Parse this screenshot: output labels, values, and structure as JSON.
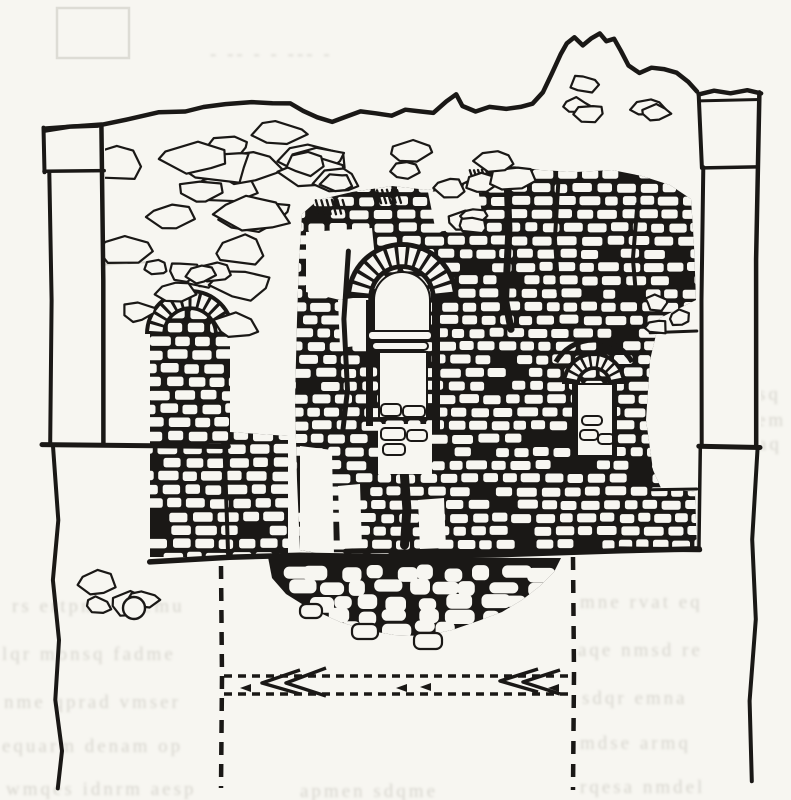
{
  "figure": {
    "description": "Scanned pen-and-ink archaeological elevation drawing of a ruined brick wall with three arched niches, flanked by two plain pilasters, rubble foundation mound below, and dashed reconstruction/section lines with left-pointing arrows at the bottom",
    "visible_text": "",
    "bleed_note": "illegible mirrored text bleeding through the page"
  },
  "palette": {
    "paper": "#f7f6f1",
    "ink": "#1a1816",
    "bleed": "#b6b4aa",
    "faint": "#c9c7bd"
  },
  "canvas": {
    "width": 791,
    "height": 800
  },
  "drawing": {
    "top_edge": [
      [
        44,
        131
      ],
      [
        70,
        127
      ],
      [
        98,
        125
      ],
      [
        128,
        119
      ],
      [
        158,
        113
      ],
      [
        186,
        112
      ],
      [
        204,
        107
      ],
      [
        226,
        104
      ],
      [
        252,
        102
      ],
      [
        272,
        103
      ],
      [
        290,
        104
      ],
      [
        303,
        111
      ],
      [
        318,
        118
      ],
      [
        332,
        122
      ],
      [
        344,
        118
      ],
      [
        360,
        112
      ],
      [
        376,
        114
      ],
      [
        392,
        116
      ],
      [
        406,
        110
      ],
      [
        420,
        112
      ],
      [
        434,
        113
      ],
      [
        447,
        101
      ],
      [
        456,
        95
      ],
      [
        463,
        106
      ],
      [
        476,
        111
      ],
      [
        490,
        107
      ],
      [
        506,
        109
      ],
      [
        520,
        107
      ],
      [
        533,
        104
      ],
      [
        543,
        92
      ],
      [
        552,
        73
      ],
      [
        560,
        55
      ],
      [
        567,
        43
      ],
      [
        575,
        38
      ],
      [
        583,
        45
      ],
      [
        591,
        38
      ],
      [
        600,
        34
      ],
      [
        607,
        41
      ],
      [
        614,
        39
      ],
      [
        621,
        51
      ],
      [
        629,
        65
      ],
      [
        640,
        73
      ],
      [
        652,
        67
      ],
      [
        664,
        69
      ],
      [
        676,
        73
      ],
      [
        688,
        82
      ],
      [
        697,
        92
      ]
    ],
    "left_pillar": {
      "fill": [
        44,
        124,
        61,
        320
      ],
      "cap_top": [
        [
          44,
          128
        ],
        [
          102,
          124
        ]
      ],
      "cap_bottom": [
        [
          44,
          172
        ],
        [
          104,
          171
        ]
      ],
      "cap_left": [
        [
          44,
          128
        ],
        [
          44,
          172
        ]
      ],
      "shaft_left": [
        [
          50,
          172
        ],
        [
          52,
          300
        ],
        [
          50,
          443
        ]
      ],
      "shaft_right": [
        [
          102,
          124
        ],
        [
          104,
          280
        ],
        [
          103,
          443
        ]
      ],
      "plinth": [
        [
          42,
          444
        ],
        [
          228,
          446
        ]
      ],
      "lower_wavy": [
        [
          53,
          446
        ],
        [
          58,
          520
        ],
        [
          52,
          580
        ],
        [
          60,
          640
        ],
        [
          55,
          700
        ],
        [
          62,
          750
        ],
        [
          58,
          788
        ]
      ]
    },
    "right_pillar": {
      "fill": [
        699,
        92,
        62,
        356
      ],
      "cap_top": [
        [
          699,
          95
        ],
        [
          714,
          90
        ],
        [
          731,
          94
        ],
        [
          747,
          90
        ],
        [
          761,
          93
        ]
      ],
      "cap_top2": [
        [
          699,
          101
        ],
        [
          760,
          100
        ]
      ],
      "cap_bottom": [
        [
          704,
          168
        ],
        [
          757,
          167
        ]
      ],
      "cap_left": [
        [
          699,
          95
        ],
        [
          702,
          168
        ]
      ],
      "shaft_left": [
        [
          703,
          168
        ],
        [
          701,
          300
        ],
        [
          702,
          445
        ]
      ],
      "shaft_right": [
        [
          759,
          93
        ],
        [
          756,
          260
        ],
        [
          757,
          445
        ]
      ],
      "plinth": [
        [
          699,
          446
        ],
        [
          760,
          448
        ]
      ],
      "left_lower": [
        [
          701,
          448
        ],
        [
          699,
          548
        ]
      ],
      "right_lower": [
        [
          757,
          448
        ],
        [
          752,
          540
        ],
        [
          756,
          620
        ],
        [
          749,
          700
        ],
        [
          752,
          780
        ]
      ],
      "base_right": [
        [
          620,
          549
        ],
        [
          700,
          550
        ]
      ]
    },
    "corner_edge": [
      [
        225,
        446
      ],
      [
        228,
        557
      ]
    ],
    "base_line": [
      [
        150,
        561
      ],
      [
        230,
        558
      ],
      [
        300,
        556
      ],
      [
        400,
        557
      ],
      [
        500,
        554
      ],
      [
        620,
        551
      ],
      [
        700,
        549
      ]
    ],
    "brick_regions": [
      {
        "id": "r2",
        "seed": 7,
        "d": "M302,214 L318,200 L352,192 L392,186 L428,190 L456,186 L474,177 L489,165 L500,157 L513,166 L540,170 L576,172 L612,170 L642,176 L670,185 L691,199 L694,245 L696,300 L660,318 L650,360 L646,420 L653,470 L661,488 L695,492 L697,549 L640,552 L560,555 L470,556 L400,557 L332,556 L300,550 L297,480 L295,400 L297,320 L299,260 Z",
        "bbox": [
          295,
          157,
          697,
          557
        ],
        "rowH": 13.2,
        "bh": 9,
        "bw": [
          12,
          21
        ],
        "mortar": 3.5,
        "skip": 0.08
      },
      {
        "id": "r1",
        "seed": 11,
        "d": "M150,557 L150,334 A40,40 0 0 1 230,334 L230,432 L288,436 L288,557 Z",
        "bbox": [
          150,
          296,
          288,
          557
        ],
        "rowH": 13.5,
        "bh": 9.5,
        "bw": [
          14,
          22
        ],
        "mortar": 4,
        "skip": 0.07
      }
    ],
    "white_patches": [
      [
        [
          306,
          232
        ],
        [
          372,
          228
        ],
        [
          378,
          288
        ],
        [
          340,
          300
        ],
        [
          306,
          292
        ]
      ],
      [
        [
          338,
          300
        ],
        [
          368,
          296
        ],
        [
          372,
          344
        ],
        [
          340,
          348
        ]
      ],
      [
        [
          428,
          192
        ],
        [
          478,
          188
        ],
        [
          484,
          226
        ],
        [
          436,
          232
        ]
      ],
      [
        [
          300,
          446
        ],
        [
          332,
          450
        ],
        [
          334,
          556
        ],
        [
          300,
          550
        ]
      ],
      [
        [
          338,
          486
        ],
        [
          360,
          484
        ],
        [
          362,
          548
        ],
        [
          340,
          549
        ]
      ],
      [
        [
          418,
          500
        ],
        [
          444,
          498
        ],
        [
          446,
          548
        ],
        [
          420,
          549
        ]
      ]
    ],
    "shelf_lines": [
      [
        [
          650,
          333
        ],
        [
          697,
          331
        ]
      ],
      [
        [
          650,
          490
        ],
        [
          697,
          489
        ]
      ]
    ],
    "cracks": [
      {
        "pts": [
          [
            506,
            162
          ],
          [
            509,
            230
          ],
          [
            505,
            300
          ],
          [
            511,
            330
          ]
        ],
        "w": 7
      },
      {
        "pts": [
          [
            348,
            252
          ],
          [
            344,
            320
          ],
          [
            347,
            390
          ],
          [
            343,
            430
          ]
        ],
        "w": 5
      },
      {
        "pts": [
          [
            558,
            182
          ],
          [
            555,
            240
          ],
          [
            558,
            292
          ]
        ],
        "w": 4
      },
      {
        "pts": [
          [
            637,
            205
          ],
          [
            633,
            260
          ],
          [
            636,
            300
          ]
        ],
        "w": 4
      },
      {
        "pts": [
          [
            404,
            476
          ],
          [
            407,
            510
          ],
          [
            404,
            545
          ]
        ],
        "w": 9
      }
    ],
    "hatch_groups": [
      [
        316,
        200,
        32,
        14
      ],
      [
        372,
        190,
        30,
        13
      ],
      [
        470,
        170,
        24,
        12
      ]
    ],
    "central_window": {
      "ring": {
        "cx": 402,
        "cy": 298,
        "rOut": 52,
        "rIn": 33,
        "pad": 4,
        "n": 13,
        "a0": 185,
        "a1": 355
      },
      "opening": "M374,300 A28,28 0 0 1 430,300 L430,331 L374,331 Z",
      "sill_slabs": [
        [
          368,
          331,
          64,
          9
        ],
        [
          372,
          342,
          56,
          8
        ]
      ],
      "slot": [
        379,
        352,
        48,
        66
      ],
      "slot_stones": [
        [
          381,
          404,
          20,
          12
        ],
        [
          403,
          406,
          22,
          11
        ]
      ],
      "lower_patch": [
        378,
        424,
        54,
        50
      ],
      "lower_stones": [
        [
          381,
          428,
          24,
          12
        ],
        [
          407,
          430,
          20,
          11
        ],
        [
          383,
          444,
          22,
          11
        ]
      ],
      "flank_bars": [
        [
          366,
          300,
          7,
          126
        ],
        [
          432,
          300,
          8,
          130
        ]
      ]
    },
    "right_arch": {
      "ring": {
        "cx": 594,
        "cy": 384,
        "rOut": 29,
        "rIn": 17,
        "pad": 3,
        "n": 9,
        "a0": 190,
        "a1": 350
      },
      "sweep": {
        "cx": 594,
        "cy": 384,
        "r": 44,
        "a0": 210,
        "a1": 330
      },
      "niche": [
        577,
        384,
        36,
        72
      ],
      "niche_stones": [
        [
          580,
          430,
          18,
          10
        ],
        [
          598,
          434,
          16,
          10
        ],
        [
          582,
          416,
          20,
          9
        ]
      ],
      "legs": [
        [
          572,
          384,
          5,
          76
        ],
        [
          612,
          384,
          5,
          76
        ]
      ],
      "base": [
        [
          572,
          458
        ],
        [
          617,
          459
        ]
      ]
    },
    "left_arch_ring": {
      "cx": 190,
      "cy": 334,
      "rOut": 42,
      "rIn": 27,
      "pad": 3,
      "n": 12,
      "a0": 182,
      "a1": 358
    },
    "stone_clusters": [
      {
        "seed": 3,
        "area": [
          112,
          130,
          230,
          100
        ],
        "n": 16,
        "smin": 9,
        "smax": 17,
        "elong": 2.1
      },
      {
        "seed": 13,
        "area": [
          108,
          248,
          180,
          85
        ],
        "n": 9,
        "smin": 8,
        "smax": 15,
        "elong": 1.9
      },
      {
        "seed": 21,
        "area": [
          318,
          150,
          200,
          46
        ],
        "n": 8,
        "smin": 7,
        "smax": 13,
        "elong": 1.8
      },
      {
        "seed": 31,
        "area": [
          432,
          196,
          46,
          30
        ],
        "n": 3,
        "smin": 6,
        "smax": 10,
        "elong": 1.6
      },
      {
        "seed": 41,
        "area": [
          560,
          84,
          104,
          46
        ],
        "n": 5,
        "smin": 6,
        "smax": 11,
        "elong": 1.7
      },
      {
        "seed": 51,
        "area": [
          650,
          300,
          48,
          34
        ],
        "n": 3,
        "smin": 6,
        "smax": 10,
        "elong": 1.5
      },
      {
        "seed": 61,
        "area": [
          96,
          578,
          62,
          38
        ],
        "n": 4,
        "smin": 7,
        "smax": 12,
        "elong": 1.6
      },
      {
        "seed": 71,
        "area": [
          150,
          268,
          86,
          28
        ],
        "n": 4,
        "smin": 6,
        "smax": 11,
        "elong": 1.8
      }
    ],
    "base_circle": [
      134,
      608,
      11
    ],
    "mound": {
      "outline": [
        [
          268,
          557
        ],
        [
          272,
          578
        ],
        [
          286,
          594
        ],
        [
          302,
          604
        ],
        [
          318,
          612
        ],
        [
          340,
          622
        ],
        [
          366,
          630
        ],
        [
          394,
          635
        ],
        [
          424,
          636
        ],
        [
          452,
          630
        ],
        [
          478,
          621
        ],
        [
          502,
          612
        ],
        [
          522,
          600
        ],
        [
          540,
          586
        ],
        [
          554,
          572
        ],
        [
          561,
          558
        ]
      ],
      "rows": [
        {
          "y": 566,
          "x0": 274,
          "x1": 552,
          "n": 10
        },
        {
          "y": 581,
          "x0": 282,
          "x1": 544,
          "n": 9
        },
        {
          "y": 596,
          "x0": 298,
          "x1": 528,
          "n": 8
        },
        {
          "y": 610,
          "x0": 316,
          "x1": 504,
          "n": 6
        },
        {
          "y": 622,
          "x0": 342,
          "x1": 466,
          "n": 4
        }
      ],
      "seed": 5,
      "fringe": [
        [
          352,
          624,
          26,
          15
        ],
        [
          414,
          633,
          28,
          16
        ],
        [
          300,
          604,
          22,
          14
        ]
      ]
    },
    "dashed": {
      "v_left": {
        "x": 221,
        "y0": 566,
        "y1": 788,
        "dash": "13 9",
        "w": 4.5
      },
      "v_right": {
        "x": 573,
        "y0": 557,
        "y1": 790,
        "dash": "13 10",
        "w": 4.5
      },
      "h_top": {
        "y": 676,
        "x0": 224,
        "x1": 570,
        "dash": "8 6",
        "w": 3.5
      },
      "h_bot": {
        "y": 694,
        "x0": 224,
        "x1": 570,
        "dash": "8 6",
        "w": 3.5
      }
    },
    "arrows": {
      "chevrons": [
        [
          [
            300,
            670
          ],
          [
            262,
            683
          ],
          [
            300,
            694
          ]
        ],
        [
          [
            326,
            668
          ],
          [
            286,
            683
          ],
          [
            326,
            696
          ]
        ],
        [
          [
            538,
            669
          ],
          [
            500,
            681
          ],
          [
            538,
            692
          ]
        ],
        [
          [
            560,
            670
          ],
          [
            523,
            682
          ],
          [
            560,
            694
          ]
        ]
      ],
      "heads": [
        [
          240,
          688
        ],
        [
          396,
          688
        ],
        [
          420,
          687
        ],
        [
          548,
          688
        ]
      ]
    },
    "faint_marks": {
      "rect": [
        57,
        8,
        72,
        50
      ],
      "lines": [
        [
          [
            78,
            266
          ],
          [
            150,
            262
          ]
        ]
      ]
    },
    "bleed_rows": [
      {
        "x": 12,
        "y": 612,
        "t": "rs ertpnm ademu"
      },
      {
        "x": 580,
        "y": 608,
        "t": "mne rvat eq"
      },
      {
        "x": 2,
        "y": 660,
        "t": "lqr monsq fadme"
      },
      {
        "x": 578,
        "y": 656,
        "t": "aqe nmsd re"
      },
      {
        "x": 4,
        "y": 708,
        "t": "nme qprad vmser"
      },
      {
        "x": 582,
        "y": 704,
        "t": "sdqr emna"
      },
      {
        "x": 2,
        "y": 752,
        "t": "equarm denam op"
      },
      {
        "x": 580,
        "y": 749,
        "t": "mdse armq"
      },
      {
        "x": 6,
        "y": 795,
        "t": "wmqes idnrm aesp"
      },
      {
        "x": 300,
        "y": 797,
        "t": "apmen sdqme"
      },
      {
        "x": 580,
        "y": 793,
        "t": "rqesa nmdel"
      },
      {
        "x": 430,
        "y": 598,
        "t": "mqa edn"
      },
      {
        "x": 758,
        "y": 400,
        "t": "sq"
      },
      {
        "x": 757,
        "y": 426,
        "t": "em"
      },
      {
        "x": 758,
        "y": 450,
        "t": "aq"
      },
      {
        "x": 210,
        "y": 60,
        "t": "- -- -  - --- -"
      }
    ]
  }
}
